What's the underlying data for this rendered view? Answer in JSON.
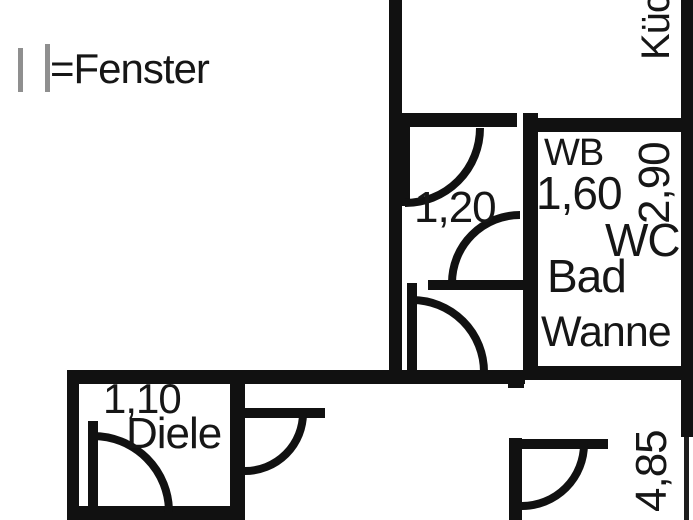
{
  "colors": {
    "wall": "#111111",
    "text": "#161616",
    "window_symbol": "#8f8f8f",
    "background": "#ffffff"
  },
  "legend": {
    "window_label": "=Fenster"
  },
  "rooms": {
    "kueche": {
      "label": "Küche"
    },
    "bad": {
      "label": "Bad",
      "washbasin": "WB",
      "wc": "WC",
      "bathtub": "Wanne",
      "width_m": "1,60",
      "depth_m": "2,90"
    },
    "flur": {
      "width_m": "1,20"
    },
    "diele": {
      "label": "Diele",
      "width_m": "1,10"
    },
    "wohnraum": {
      "depth_m": "4,85"
    }
  }
}
